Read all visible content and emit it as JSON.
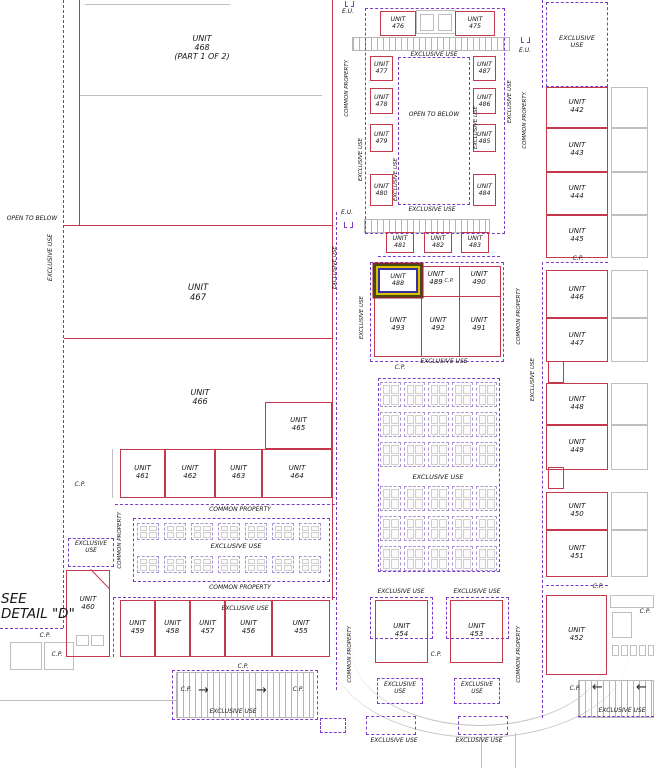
{
  "drawing_title": "SEE\nDETAIL \"D\"",
  "colors": {
    "wall_red": "#c43a4c",
    "boundary_purple": "#7c3cc8",
    "outline_gray": "#bfbfbf",
    "highlight_outer": "#8a2430",
    "highlight_olive": "#4a4a10",
    "highlight_yellow": "#d8c200",
    "highlight_blue": "#3a2f9e"
  },
  "plan": {
    "units_boxed": [
      {
        "id": "476",
        "lines": "UNIT\n476",
        "x": 380,
        "y": 11,
        "w": 36,
        "h": 25,
        "fs": 6.3
      },
      {
        "id": "475",
        "lines": "UNIT\n475",
        "x": 455,
        "y": 11,
        "w": 40,
        "h": 25,
        "fs": 6.3
      },
      {
        "id": "477",
        "lines": "UNIT\n477",
        "x": 370,
        "y": 56,
        "w": 23,
        "h": 25,
        "fs": 6.3
      },
      {
        "id": "478",
        "lines": "UNIT\n478",
        "x": 370,
        "y": 88,
        "w": 23,
        "h": 26,
        "fs": 6.3
      },
      {
        "id": "479",
        "lines": "UNIT\n479",
        "x": 370,
        "y": 124,
        "w": 23,
        "h": 28,
        "fs": 6.3
      },
      {
        "id": "480",
        "lines": "UNIT\n480",
        "x": 370,
        "y": 174,
        "w": 23,
        "h": 32,
        "fs": 6.3
      },
      {
        "id": "487",
        "lines": "UNIT\n487",
        "x": 473,
        "y": 56,
        "w": 23,
        "h": 25,
        "fs": 6.3
      },
      {
        "id": "486",
        "lines": "UNIT\n486",
        "x": 473,
        "y": 88,
        "w": 23,
        "h": 26,
        "fs": 6.3
      },
      {
        "id": "485",
        "lines": "UNIT\n485",
        "x": 473,
        "y": 124,
        "w": 23,
        "h": 28,
        "fs": 6.3
      },
      {
        "id": "484",
        "lines": "UNIT\n484",
        "x": 473,
        "y": 174,
        "w": 23,
        "h": 32,
        "fs": 6.3
      },
      {
        "id": "481",
        "lines": "UNIT\n481",
        "x": 386,
        "y": 232,
        "w": 28,
        "h": 21,
        "fs": 6.3
      },
      {
        "id": "482",
        "lines": "UNIT\n482",
        "x": 424,
        "y": 232,
        "w": 28,
        "h": 21,
        "fs": 6.3
      },
      {
        "id": "483",
        "lines": "UNIT\n483",
        "x": 461,
        "y": 232,
        "w": 28,
        "h": 21,
        "fs": 6.3
      },
      {
        "id": "488",
        "lines": "UNIT\n488",
        "x": 378,
        "y": 268,
        "w": 40,
        "h": 25,
        "fs": 6.5,
        "hl": true
      },
      {
        "id": "442",
        "lines": "UNIT\n442",
        "x": 546,
        "y": 87,
        "w": 62,
        "h": 41,
        "fs": 7
      },
      {
        "id": "443",
        "lines": "UNIT\n443",
        "x": 546,
        "y": 128,
        "w": 62,
        "h": 44,
        "fs": 7
      },
      {
        "id": "444",
        "lines": "UNIT\n444",
        "x": 546,
        "y": 172,
        "w": 62,
        "h": 43,
        "fs": 7
      },
      {
        "id": "445",
        "lines": "UNIT\n445",
        "x": 546,
        "y": 215,
        "w": 62,
        "h": 43,
        "fs": 7
      },
      {
        "id": "446",
        "lines": "UNIT\n446",
        "x": 546,
        "y": 270,
        "w": 62,
        "h": 48,
        "fs": 7
      },
      {
        "id": "447",
        "lines": "UNIT\n447",
        "x": 546,
        "y": 318,
        "w": 62,
        "h": 44,
        "fs": 7
      },
      {
        "id": "448",
        "lines": "UNIT\n448",
        "x": 546,
        "y": 383,
        "w": 62,
        "h": 42,
        "fs": 7
      },
      {
        "id": "449",
        "lines": "UNIT\n449",
        "x": 546,
        "y": 425,
        "w": 62,
        "h": 45,
        "fs": 7
      },
      {
        "id": "450",
        "lines": "UNIT\n450",
        "x": 546,
        "y": 492,
        "w": 62,
        "h": 38,
        "fs": 7
      },
      {
        "id": "451",
        "lines": "UNIT\n451",
        "x": 546,
        "y": 530,
        "w": 62,
        "h": 47,
        "fs": 7
      },
      {
        "id": "452",
        "lines": "UNIT\n452",
        "x": 546,
        "y": 595,
        "w": 61,
        "h": 80,
        "fs": 7
      },
      {
        "id": "453",
        "lines": "UNIT\n453",
        "x": 450,
        "y": 600,
        "w": 53,
        "h": 63,
        "fs": 7
      },
      {
        "id": "454",
        "lines": "UNIT\n454",
        "x": 375,
        "y": 600,
        "w": 53,
        "h": 63,
        "fs": 7
      },
      {
        "id": "455",
        "lines": "UNIT\n455",
        "x": 272,
        "y": 600,
        "w": 58,
        "h": 57,
        "fs": 7
      },
      {
        "id": "456",
        "lines": "UNIT\n456",
        "x": 225,
        "y": 600,
        "w": 47,
        "h": 57,
        "fs": 7
      },
      {
        "id": "457",
        "lines": "UNIT\n457",
        "x": 190,
        "y": 600,
        "w": 35,
        "h": 57,
        "fs": 7
      },
      {
        "id": "458",
        "lines": "UNIT\n458",
        "x": 155,
        "y": 600,
        "w": 35,
        "h": 57,
        "fs": 7
      },
      {
        "id": "459",
        "lines": "UNIT\n459",
        "x": 120,
        "y": 600,
        "w": 35,
        "h": 57,
        "fs": 7
      },
      {
        "id": "461",
        "lines": "UNIT\n461",
        "x": 120,
        "y": 449,
        "w": 45,
        "h": 49,
        "fs": 7
      },
      {
        "id": "462",
        "lines": "UNIT\n462",
        "x": 165,
        "y": 449,
        "w": 50,
        "h": 49,
        "fs": 7
      },
      {
        "id": "463",
        "lines": "UNIT\n463",
        "x": 215,
        "y": 449,
        "w": 47,
        "h": 49,
        "fs": 7
      },
      {
        "id": "464",
        "lines": "UNIT\n464",
        "x": 262,
        "y": 449,
        "w": 70,
        "h": 49,
        "fs": 7
      },
      {
        "id": "465",
        "lines": "UNIT\n465",
        "x": 265,
        "y": 402,
        "w": 67,
        "h": 47,
        "fs": 7
      }
    ],
    "units_labels": [
      {
        "id": "468",
        "lines": "UNIT\n468\n(PART 1 OF 2)",
        "x": 202,
        "y": 34,
        "fs": 8
      },
      {
        "id": "467",
        "lines": "UNIT\n467",
        "x": 198,
        "y": 284,
        "fs": 8.5
      },
      {
        "id": "466",
        "lines": "UNIT\n466",
        "x": 200,
        "y": 388,
        "fs": 8
      },
      {
        "id": "489",
        "lines": "UNIT\n489",
        "x": 436,
        "y": 271,
        "fs": 7
      },
      {
        "id": "490",
        "lines": "UNIT\n490",
        "x": 479,
        "y": 271,
        "fs": 7
      },
      {
        "id": "493",
        "lines": "UNIT\n493",
        "x": 398,
        "y": 317,
        "fs": 7
      },
      {
        "id": "492",
        "lines": "UNIT\n492",
        "x": 438,
        "y": 317,
        "fs": 7
      },
      {
        "id": "491",
        "lines": "UNIT\n491",
        "x": 479,
        "y": 317,
        "fs": 7
      },
      {
        "id": "460",
        "lines": "UNIT\n460",
        "x": 88,
        "y": 596,
        "fs": 7
      }
    ],
    "texts": [
      {
        "t": "E.U.",
        "x": 348,
        "y": 9,
        "fs": 6
      },
      {
        "t": "E.U.",
        "x": 525,
        "y": 48,
        "fs": 6
      },
      {
        "t": "E.U.",
        "x": 347,
        "y": 210,
        "fs": 6
      },
      {
        "t": "EXCLUSIVE USE",
        "x": 434,
        "y": 52,
        "fs": 6
      },
      {
        "t": "EXCLUSIVE USE",
        "x": 432,
        "y": 207,
        "fs": 6
      },
      {
        "t": "OPEN TO BELOW",
        "x": 434,
        "y": 112,
        "fs": 6
      },
      {
        "t": "OPEN TO BELOW",
        "x": 32,
        "y": 216,
        "fs": 6
      },
      {
        "t": "EXCLUSIVE\nUSE",
        "x": 577,
        "y": 35,
        "fs": 6.5
      },
      {
        "t": "EXCLUSIVE USE",
        "x": 444,
        "y": 359,
        "fs": 6
      },
      {
        "t": "EXCLUSIVE USE",
        "x": 438,
        "y": 474,
        "fs": 6.5
      },
      {
        "t": "EXCLUSIVE USE",
        "x": 236,
        "y": 543,
        "fs": 6.5
      },
      {
        "t": "EXCLUSIVE\nUSE",
        "x": 91,
        "y": 541,
        "fs": 5.8
      },
      {
        "t": "COMMON PROPERTY",
        "x": 240,
        "y": 507,
        "fs": 6
      },
      {
        "t": "COMMON PROPERTY",
        "x": 240,
        "y": 585,
        "fs": 6
      },
      {
        "t": "EXCLUSIVE USE",
        "x": 245,
        "y": 606,
        "fs": 6
      },
      {
        "t": "EXCLUSIVE USE",
        "x": 401,
        "y": 589,
        "fs": 6
      },
      {
        "t": "EXCLUSIVE USE",
        "x": 477,
        "y": 589,
        "fs": 6
      },
      {
        "t": "EXCLUSIVE USE",
        "x": 233,
        "y": 709,
        "fs": 6
      },
      {
        "t": "EXCLUSIVE USE",
        "x": 622,
        "y": 708,
        "fs": 6
      },
      {
        "t": "EXCLUSIVE\nUSE",
        "x": 400,
        "y": 682,
        "fs": 5.8
      },
      {
        "t": "EXCLUSIVE\nUSE",
        "x": 477,
        "y": 682,
        "fs": 5.8
      },
      {
        "t": "EXCLUSIVE USE",
        "x": 394,
        "y": 738,
        "fs": 6
      },
      {
        "t": "EXCLUSIVE USE",
        "x": 479,
        "y": 738,
        "fs": 6
      },
      {
        "t": "C.P.",
        "x": 449,
        "y": 279,
        "fs": 5
      },
      {
        "t": "C.P.",
        "x": 578,
        "y": 256,
        "fs": 6
      },
      {
        "t": "C.P.",
        "x": 598,
        "y": 584,
        "fs": 6
      },
      {
        "t": "C.P.",
        "x": 80,
        "y": 482,
        "fs": 6
      },
      {
        "t": "C.P.",
        "x": 436,
        "y": 652,
        "fs": 6
      },
      {
        "t": "C.P.",
        "x": 400,
        "y": 365,
        "fs": 6
      },
      {
        "t": "C.P.",
        "x": 243,
        "y": 664,
        "fs": 6
      },
      {
        "t": "C.P.",
        "x": 186,
        "y": 687,
        "fs": 6
      },
      {
        "t": "C.P.",
        "x": 298,
        "y": 687,
        "fs": 6
      },
      {
        "t": "C.P.",
        "x": 575,
        "y": 686,
        "fs": 6
      },
      {
        "t": "C.P.",
        "x": 645,
        "y": 609,
        "fs": 6
      },
      {
        "t": "C.P.",
        "x": 45,
        "y": 633,
        "fs": 6
      },
      {
        "t": "C.P.",
        "x": 57,
        "y": 652,
        "fs": 6
      },
      {
        "t": "SEE\nDETAIL \"D\"",
        "x": 1,
        "y": 592,
        "fs": 13.5,
        "left": true
      }
    ],
    "texts_rot": [
      {
        "t": "EXCLUSIVE USE",
        "x": 48,
        "y": 234,
        "fs": 6
      },
      {
        "t": "COMMON PROPERTY",
        "x": 345,
        "y": 60,
        "fs": 5.5
      },
      {
        "t": "EXCLUSIVE USE",
        "x": 359,
        "y": 138,
        "fs": 5.5
      },
      {
        "t": "EXCLUSIVE USE",
        "x": 394,
        "y": 158,
        "fs": 5.5
      },
      {
        "t": "EXCLUSIVE USE",
        "x": 474,
        "y": 106,
        "fs": 5.5
      },
      {
        "t": "EXCLUSIVE USE",
        "x": 508,
        "y": 80,
        "fs": 5.5
      },
      {
        "t": "COMMON PROPERTY",
        "x": 523,
        "y": 92,
        "fs": 5.5
      },
      {
        "t": "EXCLUSIVE USE",
        "x": 333,
        "y": 246,
        "fs": 5.5
      },
      {
        "t": "EXCLUSIVE USE",
        "x": 360,
        "y": 296,
        "fs": 5.5
      },
      {
        "t": "COMMON PROPERTY",
        "x": 517,
        "y": 288,
        "fs": 5.5
      },
      {
        "t": "EXCLUSIVE USE",
        "x": 531,
        "y": 358,
        "fs": 5.5
      },
      {
        "t": "COMMON PROPERTY",
        "x": 118,
        "y": 512,
        "fs": 5.5
      },
      {
        "t": "COMMON PROPERTY",
        "x": 348,
        "y": 626,
        "fs": 5.5
      },
      {
        "t": "COMMON PROPERTY",
        "x": 517,
        "y": 626,
        "fs": 5.5
      }
    ],
    "red_h": [
      [
        64,
        225,
        268
      ],
      [
        64,
        338,
        268
      ],
      [
        374,
        296,
        127
      ]
    ],
    "red_v": [
      [
        79,
        0,
        226
      ],
      [
        332,
        0,
        600
      ],
      [
        421,
        267,
        89
      ],
      [
        459,
        267,
        89
      ]
    ],
    "red_rects": [
      [
        374,
        266,
        127,
        91
      ],
      [
        548,
        361,
        16,
        22
      ],
      [
        548,
        467,
        16,
        22
      ],
      [
        66,
        570,
        44,
        87
      ]
    ],
    "chamfer": [
      91,
      569,
      27,
      46
    ],
    "purple_h": [
      [
        0,
        628,
        63
      ],
      [
        378,
        256,
        122
      ],
      [
        115,
        504,
        220
      ],
      [
        113,
        597,
        222
      ],
      [
        546,
        262,
        62
      ],
      [
        546,
        585,
        62
      ],
      [
        578,
        716,
        76
      ]
    ],
    "purple_v": [
      [
        63,
        0,
        628
      ],
      [
        336,
        212,
        478
      ],
      [
        542,
        0,
        88
      ],
      [
        542,
        262,
        326
      ],
      [
        542,
        590,
        128
      ],
      [
        113,
        597,
        60
      ]
    ],
    "purple_rects": [
      [
        365,
        8,
        140,
        226
      ],
      [
        398,
        57,
        72,
        148
      ],
      [
        546,
        2,
        62,
        85
      ],
      [
        370,
        262,
        134,
        100
      ],
      [
        378,
        378,
        122,
        194
      ],
      [
        133,
        518,
        197,
        64
      ],
      [
        172,
        670,
        146,
        50
      ],
      [
        68,
        538,
        46,
        29
      ],
      [
        377,
        678,
        46,
        26
      ],
      [
        454,
        678,
        46,
        26
      ],
      [
        320,
        718,
        26,
        15
      ],
      [
        366,
        716,
        50,
        19
      ],
      [
        458,
        716,
        50,
        19
      ],
      [
        370,
        597,
        63,
        42
      ],
      [
        446,
        597,
        63,
        42
      ]
    ],
    "gray_h": [
      [
        85,
        4,
        145
      ],
      [
        79,
        95,
        243
      ],
      [
        0,
        700,
        176
      ]
    ],
    "gray_v": [
      [
        112,
        449,
        49
      ],
      [
        481,
        735,
        33
      ],
      [
        515,
        733,
        35
      ]
    ],
    "gray_rects": [
      [
        611,
        87,
        37,
        41
      ],
      [
        611,
        128,
        37,
        44
      ],
      [
        611,
        172,
        37,
        43
      ],
      [
        611,
        215,
        37,
        43
      ],
      [
        611,
        270,
        37,
        48
      ],
      [
        611,
        318,
        37,
        44
      ],
      [
        611,
        383,
        37,
        42
      ],
      [
        611,
        425,
        37,
        45
      ],
      [
        611,
        492,
        37,
        38
      ],
      [
        611,
        530,
        37,
        47
      ],
      [
        416,
        10,
        40,
        24
      ],
      [
        420,
        14,
        14,
        17
      ],
      [
        438,
        14,
        14,
        17
      ],
      [
        10,
        642,
        32,
        28
      ],
      [
        44,
        642,
        30,
        28
      ],
      [
        76,
        635,
        13,
        11
      ],
      [
        91,
        635,
        13,
        11
      ],
      [
        610,
        595,
        44,
        13
      ],
      [
        612,
        612,
        20,
        26
      ],
      [
        612,
        645,
        7,
        11
      ],
      [
        621,
        645,
        7,
        11
      ],
      [
        630,
        645,
        7,
        11
      ],
      [
        639,
        645,
        7,
        11
      ],
      [
        648,
        645,
        6,
        11
      ]
    ],
    "stairs": [
      [
        352,
        37,
        158,
        14
      ],
      [
        364,
        219,
        126,
        14
      ],
      [
        176,
        672,
        138,
        46
      ],
      [
        578,
        680,
        76,
        38
      ]
    ],
    "arrows": [
      {
        "t": "→",
        "x": 198,
        "y": 684,
        "fs": 13
      },
      {
        "t": "→",
        "x": 256,
        "y": 684,
        "fs": 13
      },
      {
        "t": "←",
        "x": 592,
        "y": 681,
        "fs": 13
      },
      {
        "t": "←",
        "x": 636,
        "y": 681,
        "fs": 13
      }
    ],
    "eu_brackets": [
      [
        345,
        1
      ],
      [
        521,
        37
      ],
      [
        344,
        222
      ]
    ],
    "entry_arcs": [
      [
        330,
        650,
        300,
        88
      ],
      [
        352,
        650,
        256,
        76
      ]
    ],
    "table_area_left": {
      "x0": 137,
      "cols": 7,
      "dx": 27,
      "rows_y": [
        523,
        556
      ],
      "gw": 22,
      "gh": 17
    },
    "table_area_central": {
      "x0": 380,
      "cols": 5,
      "dx": 24,
      "rows_y": [
        382,
        412,
        442,
        486,
        516,
        546
      ],
      "gw": 21,
      "gh": 25
    }
  }
}
